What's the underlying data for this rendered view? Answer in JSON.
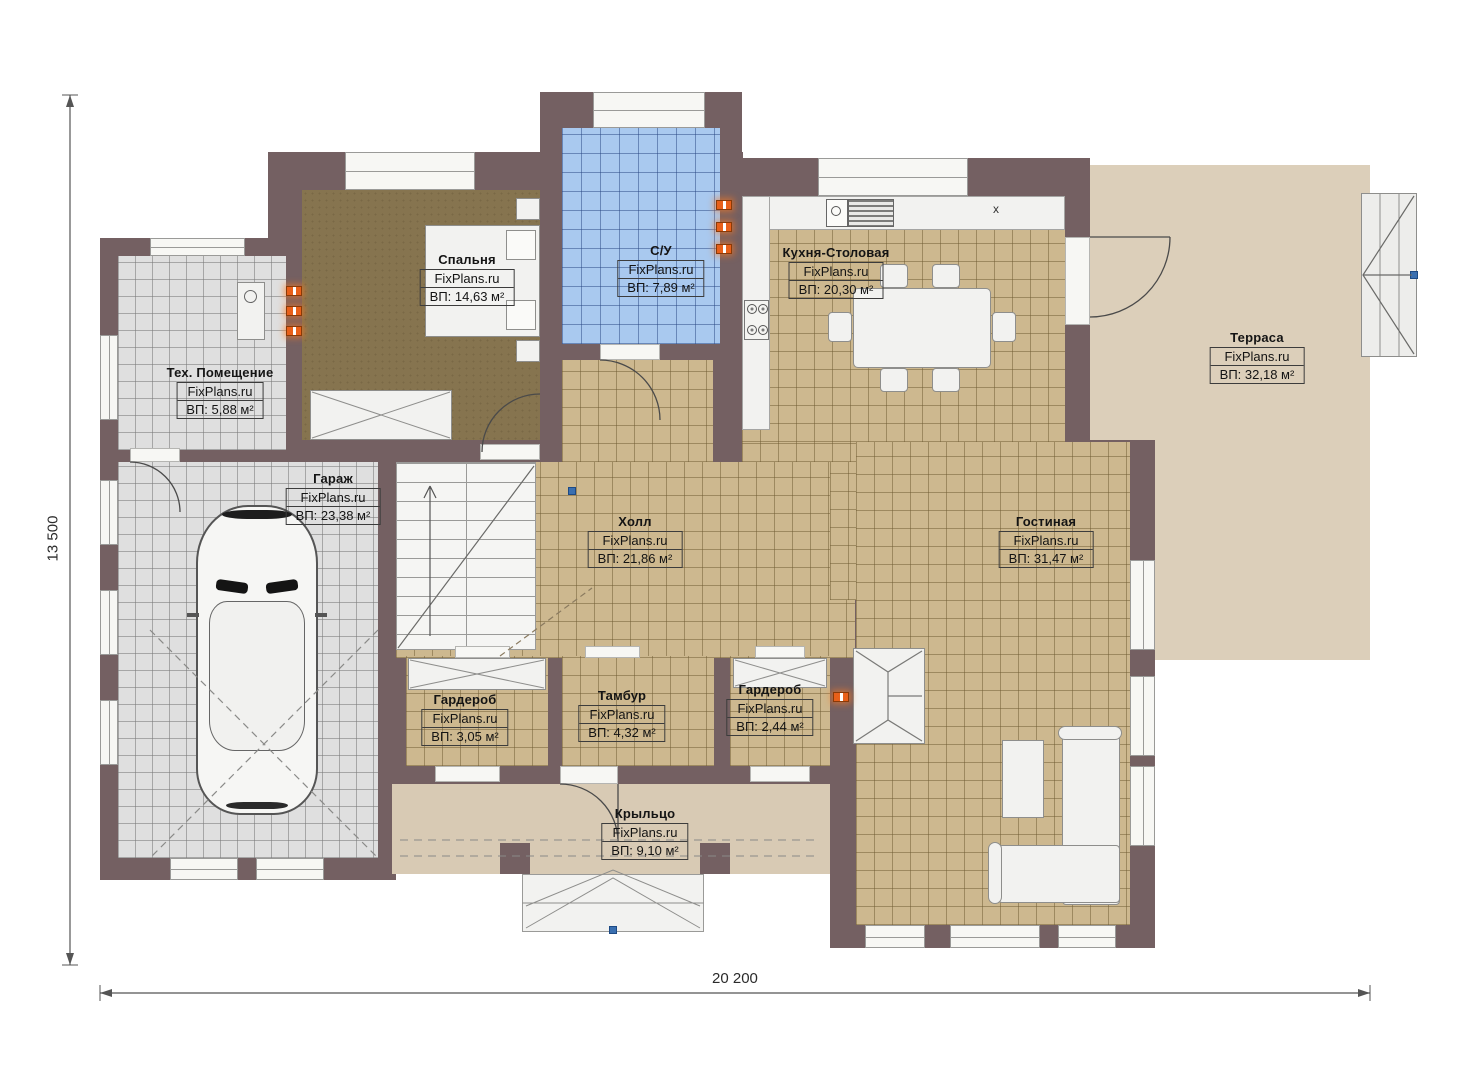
{
  "plan": {
    "brand": "FixPlans.ru",
    "dimension_width": "20 200",
    "dimension_height": "13 500",
    "kitchen_marker": "x",
    "rooms": [
      {
        "name": "Спальня",
        "area": "ВП: 14,63 м²"
      },
      {
        "name": "С/У",
        "area": "ВП: 7,89 м²"
      },
      {
        "name": "Кухня-Столовая",
        "area": "ВП: 20,30 м²"
      },
      {
        "name": "Терраса",
        "area": "ВП: 32,18 м²"
      },
      {
        "name": "Тех. Помещение",
        "area": "ВП: 5,88 м²"
      },
      {
        "name": "Гараж",
        "area": "ВП: 23,38 м²"
      },
      {
        "name": "Холл",
        "area": "ВП: 21,86 м²"
      },
      {
        "name": "Гостиная",
        "area": "ВП: 31,47 м²"
      },
      {
        "name": "Гардероб",
        "area": "ВП: 3,05 м²"
      },
      {
        "name": "Тамбур",
        "area": "ВП: 4,32 м²"
      },
      {
        "name": "Гардероб",
        "area": "ВП: 2,44 м²"
      },
      {
        "name": "Крыльцо",
        "area": "ВП: 9,10 м²"
      }
    ],
    "colors": {
      "wall": "#746062",
      "tile_beige": "#cdb88f",
      "tile_gray": "#dfdfdf",
      "tile_blue": "#a9c9ef",
      "bedroom_floor": "#86744f",
      "terrace": "#dccfba",
      "porch": "#d8cab4",
      "radiator": "#e8601a"
    }
  }
}
